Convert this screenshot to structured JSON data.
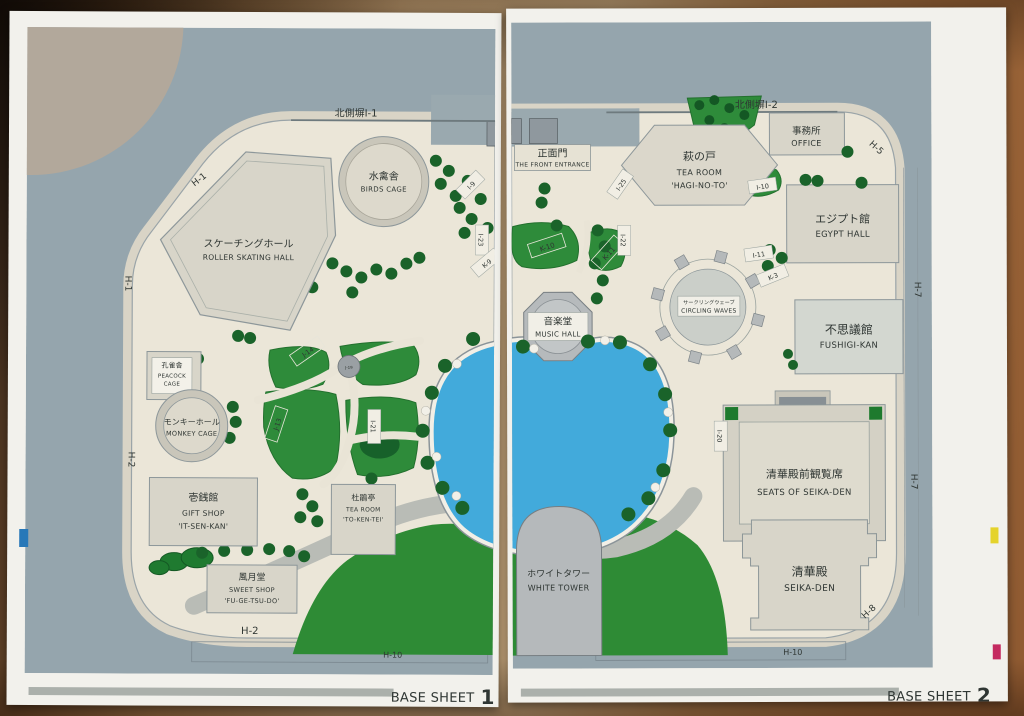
{
  "photo_kind": "printed park base map, two sheets on wooden table",
  "colors": {
    "paper": "#f2f1ec",
    "map_grey": "#95a5ad",
    "park_cream": "#ebe6d8",
    "building": "#d8d5c9",
    "structure_grey": "#b6babc",
    "park_green": "#2e8b3a",
    "tree_green": "#1a632a",
    "pond_blue": "#42aadb",
    "reg_cyan": "#2878b8",
    "reg_yellow": "#e5d32b",
    "reg_magenta": "#c42a60"
  },
  "sheet1": {
    "base_label": "BASE SHEET",
    "number": "1",
    "wall": "北側塀I-1",
    "edges": {
      "h1a": "H-1",
      "h1b": "H-1",
      "h2a": "H-2",
      "h2b": "H-2",
      "h10": "H-10"
    },
    "skating_jp": "スケーチングホール",
    "skating_en": "ROLLER SKATING HALL",
    "birds_jp": "水禽舎",
    "birds_en": "BIRDS CAGE",
    "peacock_jp": "孔雀舎",
    "peacock_en1": "PEACOCK",
    "peacock_en2": "CAGE",
    "monkey_jp": "モンキーホール",
    "monkey_en": "MONKEY CAGE",
    "gift_jp": "壱銭館",
    "gift_en1": "GIFT SHOP",
    "gift_en2": "'IT-SEN-KAN'",
    "token_jp": "杜鵑亭",
    "token_en1": "TEA ROOM",
    "token_en2": "'TO-KEN-TEI'",
    "sweet_jp": "風月堂",
    "sweet_en1": "SWEET SHOP",
    "sweet_en2": "'FU-GE-TSU-DO'",
    "tags": {
      "j14": "J-14",
      "j13": "J-13",
      "j19": "J-19",
      "i21": "I-21",
      "i23": "I-23",
      "k9": "K-9",
      "i9": "I-9"
    }
  },
  "sheet2": {
    "base_label": "BASE SHEET",
    "number": "2",
    "wall": "北側塀I-2",
    "edges": {
      "h5": "H-5",
      "h7a": "H-7",
      "h7b": "H-7",
      "h8": "H-8",
      "h10": "H-10"
    },
    "entrance_jp": "正面門",
    "entrance_en": "THE FRONT ENTRANCE",
    "hagi_jp": "萩の戸",
    "hagi_en1": "TEA ROOM",
    "hagi_en2": "'HAGI-NO-TO'",
    "office_jp": "事務所",
    "office_en": "OFFICE",
    "egypt_jp": "エジプト館",
    "egypt_en": "EGYPT HALL",
    "fushigi_jp": "不思議館",
    "fushigi_en": "FUSHIGI-KAN",
    "circling_jp": "サークリングウェーブ",
    "circling_en": "CIRCLING WAVES",
    "music_jp": "音楽堂",
    "music_en": "MUSIC HALL",
    "seats_jp": "清華殿前観覧席",
    "seats_en": "SEATS OF SEIKA-DEN",
    "seika_jp": "清華殿",
    "seika_en": "SEIKA-DEN",
    "tower_jp": "ホワイトタワー",
    "tower_en": "WHITE TOWER",
    "tags": {
      "i10": "I-10",
      "i11": "I-11",
      "k3": "K-3",
      "k10": "K-10",
      "k11": "K-11",
      "i22": "I-22",
      "i25": "I-25",
      "i20": "I-20"
    }
  }
}
